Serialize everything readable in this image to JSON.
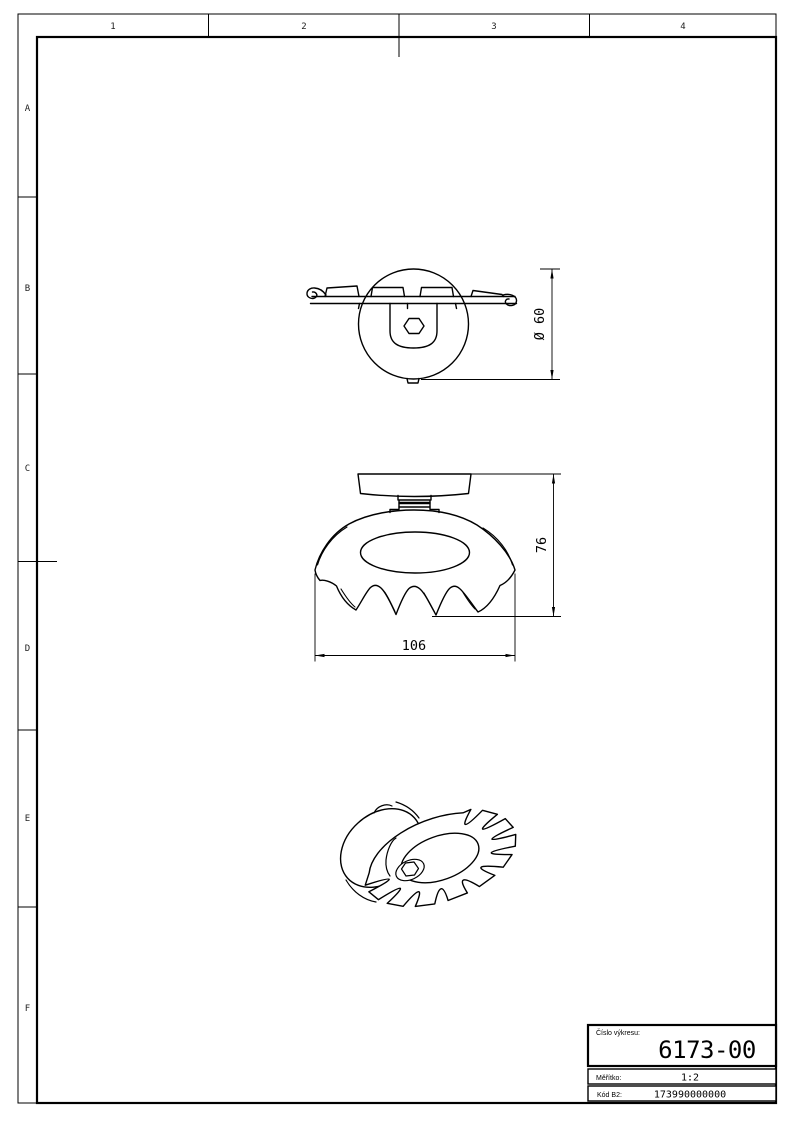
{
  "sheet": {
    "grid": {
      "columns": [
        "1",
        "2",
        "3",
        "4"
      ],
      "rows": [
        "A",
        "B",
        "C",
        "D",
        "E",
        "F"
      ]
    }
  },
  "drawing": {
    "top_view": {
      "dimension_diameter": "Ø 60"
    },
    "front_view": {
      "dimension_height": "76",
      "dimension_width": "106"
    },
    "isometric_view": {
      "description": "serrated-cone-washer-with-hub"
    }
  },
  "title_block": {
    "drawing_number_label": "Číslo výkresu:",
    "drawing_number": "6173-00",
    "scale_label": "Měřítko:",
    "scale_value": "1:2",
    "code_label": "Kód B2:",
    "code_value": "173990000000"
  },
  "colors": {
    "line": "#000000",
    "background": "#ffffff"
  }
}
